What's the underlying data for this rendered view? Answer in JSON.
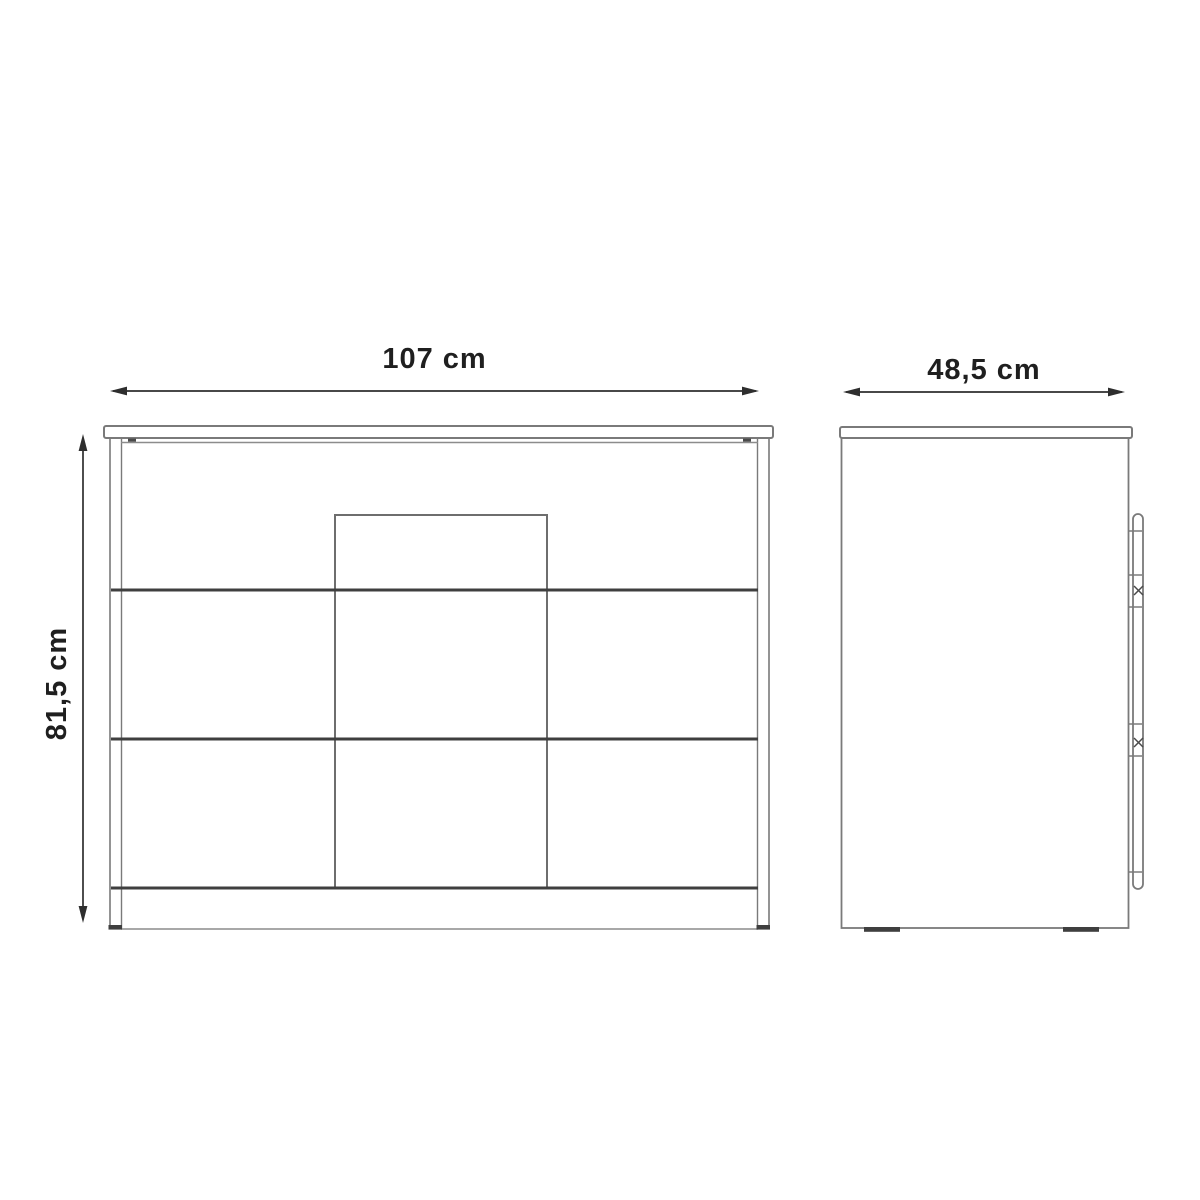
{
  "diagram": {
    "type": "furniture-dimension-drawing",
    "subject": "chest-of-drawers front elevation and side elevation with overall dimensions",
    "views": {
      "front": {
        "name": "front-view",
        "drawer_dividers": 3,
        "has_center_panel": true
      },
      "side": {
        "name": "side-view",
        "has_front-strip_profile": true
      }
    },
    "labels": {
      "width": "107 cm",
      "depth": "48,5 cm",
      "height": "81,5 cm"
    },
    "units": "cm",
    "values": {
      "width_cm": 107,
      "depth_cm": 48.5,
      "height_cm": 81.5
    },
    "colors": {
      "background": "#ffffff",
      "outline": "#7a7a7a",
      "outline_light": "#8c8c8c",
      "outline_dark": "#3f3f3f",
      "dimension_line": "#2e2e2e",
      "text": "#1f1f1f"
    }
  }
}
